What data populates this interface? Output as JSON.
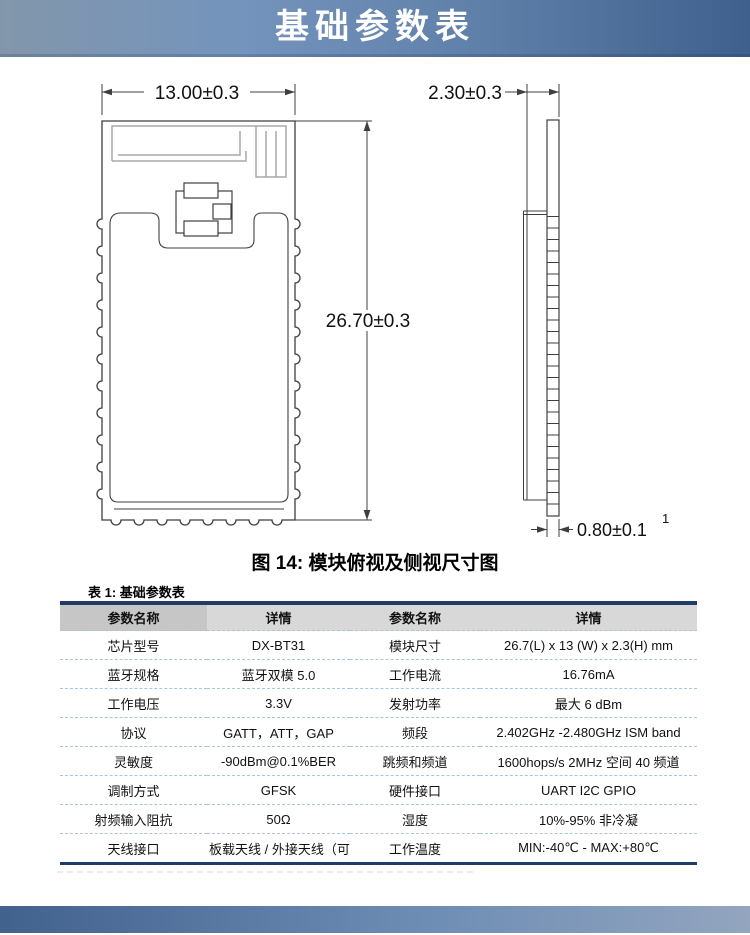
{
  "banner": {
    "title": "基础参数表"
  },
  "figure": {
    "caption": "图 14: 模块俯视及侧视尺寸图",
    "dim_width": "13.00±0.3",
    "dim_length": "26.70±0.3",
    "dim_thickness": "2.30±0.3",
    "dim_pad_thickness": "0.80±0.1",
    "dim_pad_superscript": "1"
  },
  "table": {
    "title": "表 1: 基础参数表",
    "headers": [
      "参数名称",
      "详情",
      "参数名称",
      "详情"
    ],
    "rows": [
      [
        "芯片型号",
        "DX-BT31",
        "模块尺寸",
        "26.7(L) x 13 (W) x 2.3(H) mm"
      ],
      [
        "蓝牙规格",
        "蓝牙双模 5.0",
        "工作电流",
        "16.76mA"
      ],
      [
        "工作电压",
        "3.3V",
        "发射功率",
        "最大 6 dBm"
      ],
      [
        "协议",
        "GATT，ATT，GAP",
        "频段",
        "2.402GHz -2.480GHz ISM band"
      ],
      [
        "灵敏度",
        "-90dBm@0.1%BER",
        "跳频和频道",
        "1600hops/s 2MHz 空间 40 频道"
      ],
      [
        "调制方式",
        "GFSK",
        "硬件接口",
        "UART I2C GPIO"
      ],
      [
        "射频输入阻抗",
        "50Ω",
        "湿度",
        "10%-95% 非冷凝"
      ],
      [
        "天线接口",
        "板载天线 / 外接天线（可选）",
        "工作温度",
        "MIN:-40℃ - MAX:+80℃"
      ]
    ]
  },
  "colors": {
    "banner_gradient_left": "#8296ab",
    "banner_gradient_right": "#3f608d",
    "table_border_navy": "#1f3c68",
    "table_header_bg": "#d8d8d8",
    "table_header_first_bg": "#c6c6c6",
    "row_separator_dashed": "#a9c4de",
    "drawing_line": "#3f3f3f",
    "antenna_trace": "#a8a8a8",
    "footer_gradient_left": "#42628e",
    "footer_gradient_right": "#93a5bf"
  }
}
